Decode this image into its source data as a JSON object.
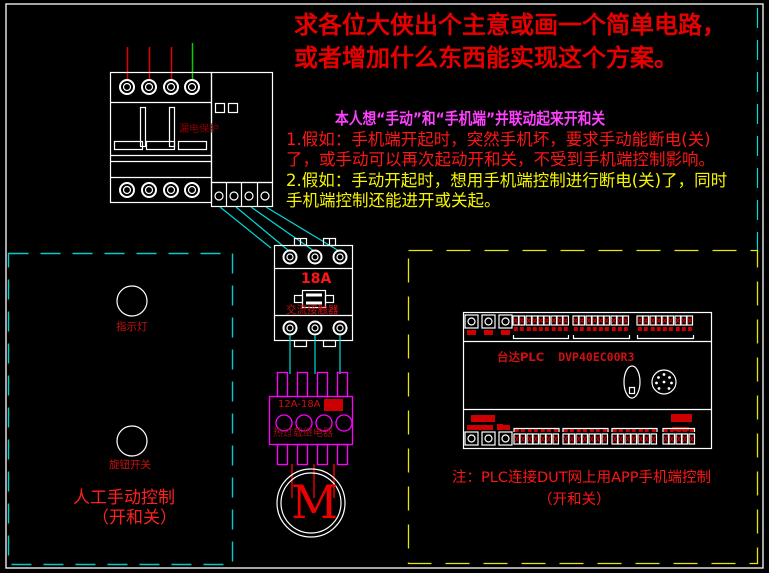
{
  "colors": {
    "bg": "#000000",
    "device_white": "#ffffff",
    "wire_red": "#e00000",
    "wire_green": "#00cc00",
    "wire_cyan": "#00dddd",
    "box_cyan": "#00cccc",
    "box_yellow": "#e8e800",
    "relay_magenta": "#ff00ff",
    "red_fill": "#cc0000",
    "title_red": "#e60000",
    "body_red": "#ff1515",
    "body_magenta": "#ff40ff",
    "body_yellow": "#f5f500",
    "label_red": "#cc1111",
    "label_dark_red": "#8b0000",
    "motor_red": "#ee0000"
  },
  "request_note": {
    "line1": "求各位大侠出个主意或画一个简单电路，",
    "line2": "或者增加什么东西能实现这个方案。"
  },
  "plan_note": {
    "heading": "本人想“手动”和“手机端”并联动起来开和关",
    "case1_line1": "1.假如：手机端开起时，突然手机坏，要求手动能断电(关)",
    "case1_line2": "了，或手动可以再次起动开和关，不受到手机端控制影响。",
    "case2_line1": "2.假如：手动开起时，想用手机端控制进行断电(关)了，同时",
    "case2_line2": "手机端控制还能进开或关起。"
  },
  "breaker": {
    "label": "漏电保护"
  },
  "contactor": {
    "rating": "18A",
    "label": "交流接触器"
  },
  "thermal_relay": {
    "rating": "12A-18A",
    "label": "热过载继电器"
  },
  "motor": {
    "symbol": "M"
  },
  "manual_panel": {
    "indicator_label": "指示灯",
    "knob_label": "旋钮开关",
    "caption_line1": "人工手动控制",
    "caption_line2": "（开和关）"
  },
  "plc": {
    "brand": "台达PLC",
    "model": "DVP40EC00R3",
    "note_line1": "注：PLC连接DUT网上用APP手机端控制",
    "note_line2": "（开和关）"
  }
}
